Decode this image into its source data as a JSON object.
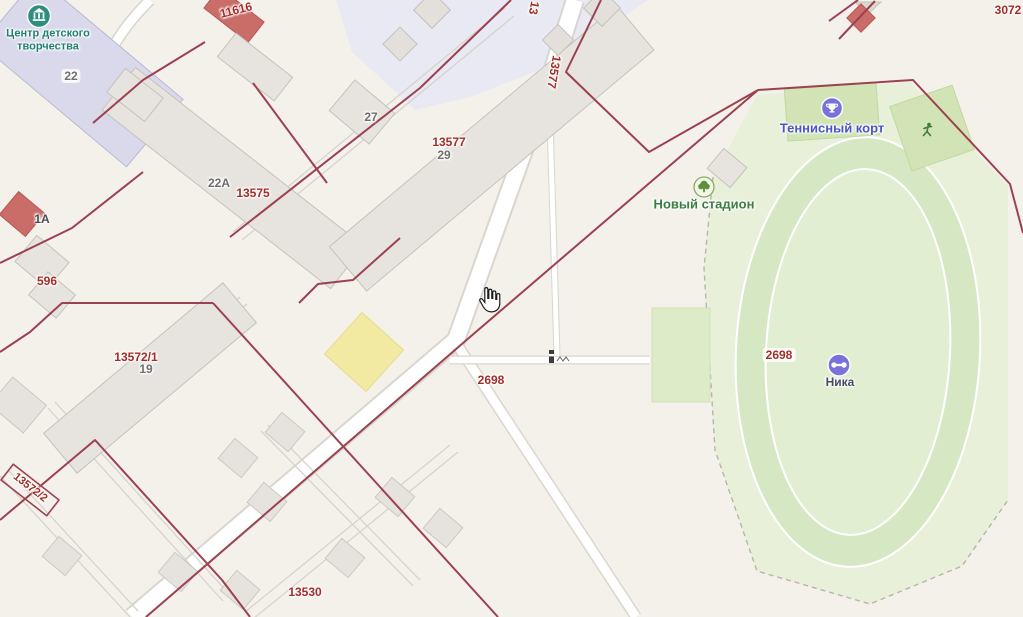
{
  "map": {
    "provider_style": "2gis-like cadastral map",
    "cursor": "hand-pointer"
  },
  "colors": {
    "background": "#f4f1eb",
    "parcel_boundary_red": "#9c4150",
    "parcel_label_red": "#a22d28",
    "building_label_grey": "#6e6e6e",
    "lavender_zone": "#e9e9f4",
    "building_grey": "#e7e4df",
    "building_lavender": "#d9d9eb",
    "building_red": "#ca6d68",
    "yellow_parcel": "#f2eaa2",
    "stadium_zone_green": "#e8f0da",
    "stadium_track_green": "#d6e7c3",
    "stadium_infield_green": "#e2eed2",
    "sport_rect_green": "#d2e4b6",
    "poi_purple": "#7b72d9",
    "poi_teal": "#2e8d7e",
    "tennis_label_blue": "#4a54c8",
    "stadium_label_green": "#39803f",
    "children_center_label_teal": "#1f7f71"
  },
  "poi": {
    "children_center": {
      "name_line1": "Центр детского",
      "name_line2": "творчества",
      "house_number": "22"
    },
    "tennis_court_label": "Теннисный корт",
    "stadium_label": "Новый стадион",
    "gym_label": "Ника"
  },
  "parcels": {
    "label_13577_side": "13577",
    "label_13_top": "13",
    "label_13577": "13577",
    "label_13575": "13575",
    "label_13572_1": "13572/1",
    "label_13572_2": "13572/2",
    "label_13530": "13530",
    "label_2698_road": "2698",
    "label_2698_stadium": "2698",
    "label_3072": "3072",
    "label_11616": "11616",
    "label_596": "596"
  },
  "buildings": {
    "label_22": "22",
    "label_22a": "22А",
    "label_27": "27",
    "label_29": "29",
    "label_19": "19",
    "label_1a": "1А"
  }
}
